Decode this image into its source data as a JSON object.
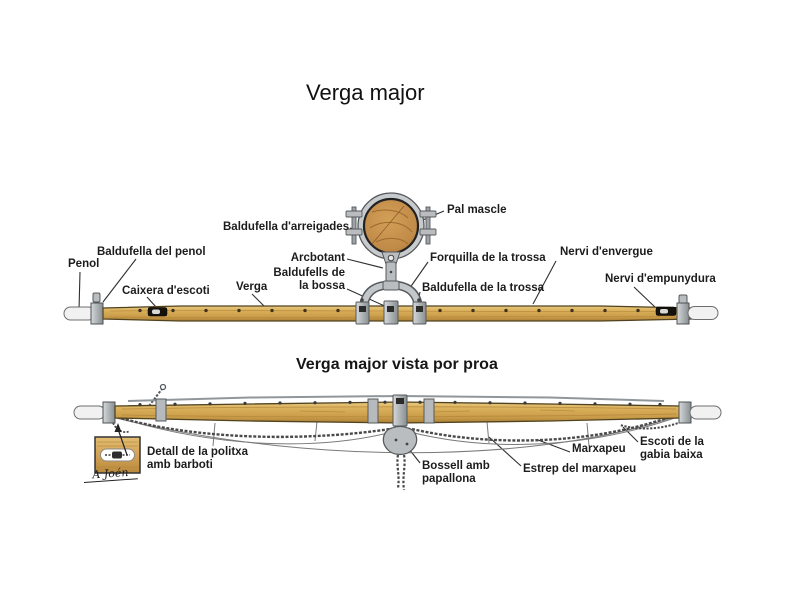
{
  "title": "Verga major",
  "upper": {
    "labels": {
      "penol": "Penol",
      "baldufella_del_penol": "Baldufella del penol",
      "caixera_descoti": "Caixera d'escoti",
      "verga": "Verga",
      "baldufella_darreigades": "Baldufella d'arreigades",
      "arcbotant": "Arcbotant",
      "baldufells_de_la_bossa": "Baldufells de la bossa",
      "pal_mascle": "Pal mascle",
      "forquilla_de_la_trossa": "Forquilla de la trossa",
      "baldufella_de_la_trossa": "Baldufella de la trossa",
      "nervi_denvergue": "Nervi d'envergue",
      "nervi_dempunydura": "Nervi d'empunydura"
    }
  },
  "lower": {
    "subtitle": "Verga major vista por proa",
    "signature": "A Joén",
    "labels": {
      "detall_politxa": "Detall de la politxa amb barboti",
      "bossell_amb_papallona": "Bossell amb papallona",
      "estrep_del_marxapeu": "Estrep del marxapeu",
      "marxapeu": "Marxapeu",
      "escoti_gabia_baixa": "Escoti de la gabia baixa"
    }
  },
  "colors": {
    "background": "#ffffff",
    "text": "#1c1c1c",
    "leader_line": "#2f2f2f",
    "wood_light": "#e7c87e",
    "wood_mid": "#d9ae58",
    "wood_dark": "#aa7e35",
    "metal": "#aeb3b5",
    "metal_dark": "#55595c",
    "chain": "#4a4a4a",
    "tip_white": "#f1f1f1"
  }
}
